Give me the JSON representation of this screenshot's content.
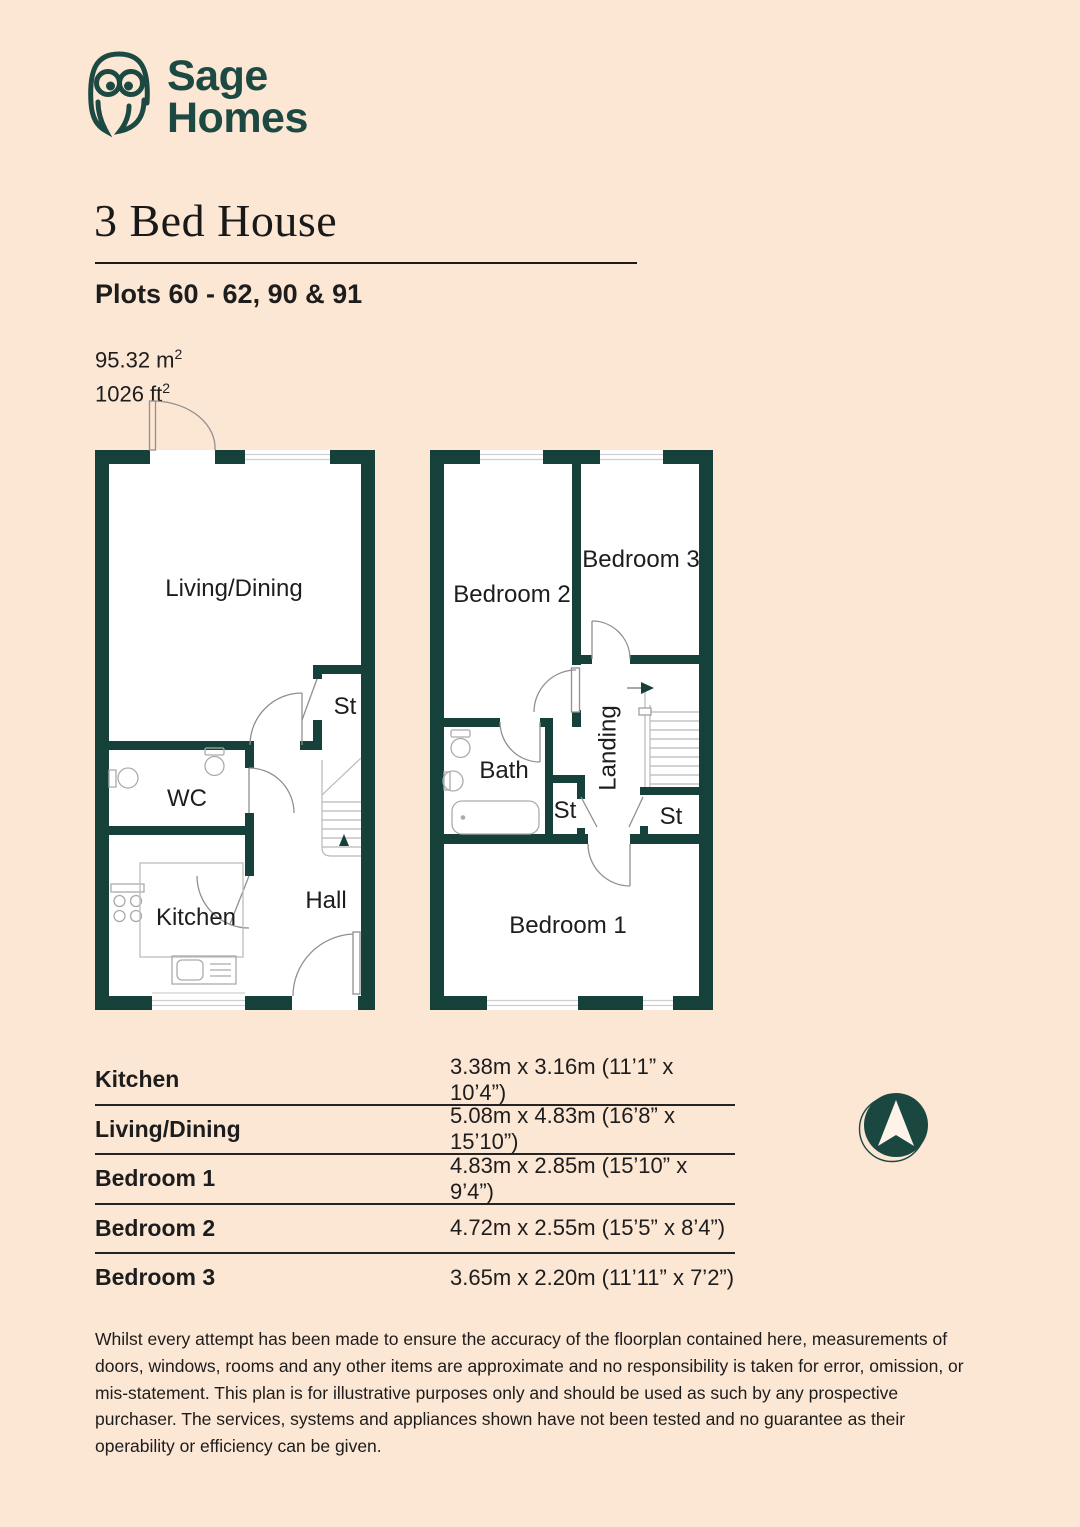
{
  "colors": {
    "background": "#fce6d4",
    "brand_teal": "#1c4a42",
    "wall_teal": "#16413a",
    "ink": "#1d1d1d"
  },
  "logo": {
    "name_line_1": "Sage",
    "name_line_2": "Homes"
  },
  "header": {
    "title": "3 Bed House",
    "plots_line": "Plots 60 - 62, 90 & 91",
    "area_metric_value": "95.32 m",
    "area_metric_sup": "2",
    "area_imperial_value": "1026 ft",
    "area_imperial_sup": "2"
  },
  "ground_floor_labels": {
    "living_dining": "Living/Dining",
    "st": "St",
    "wc": "WC",
    "kitchen": "Kitchen",
    "hall": "Hall"
  },
  "first_floor_labels": {
    "bedroom_2": "Bedroom 2",
    "bedroom_3": "Bedroom 3",
    "bath": "Bath",
    "landing": "Landing",
    "st_1": "St",
    "st_2": "St",
    "bedroom_1": "Bedroom 1"
  },
  "dimensions_table": {
    "rows": [
      {
        "room": "Kitchen",
        "size": "3.38m x 3.16m (11’1” x 10’4”)"
      },
      {
        "room": "Living/Dining",
        "size": "5.08m x 4.83m (16’8” x 15’10”)"
      },
      {
        "room": "Bedroom 1",
        "size": "4.83m x 2.85m (15’10” x 9’4”)"
      },
      {
        "room": "Bedroom 2",
        "size": "4.72m x 2.55m (15’5” x 8’4”)"
      },
      {
        "room": "Bedroom 3",
        "size": "3.65m x 2.20m (11’11” x 7’2”)"
      }
    ]
  },
  "disclaimer": "Whilst every attempt has been made to ensure the accuracy of the floorplan contained here, measurements of doors, windows, rooms and any other items are approximate and no responsibility is taken for error, omission, or mis-statement. This plan is for illustrative purposes only and should be used as such by any prospective purchaser. The services, systems and appliances shown have not been tested and no guarantee as their operability or efficiency can be given."
}
